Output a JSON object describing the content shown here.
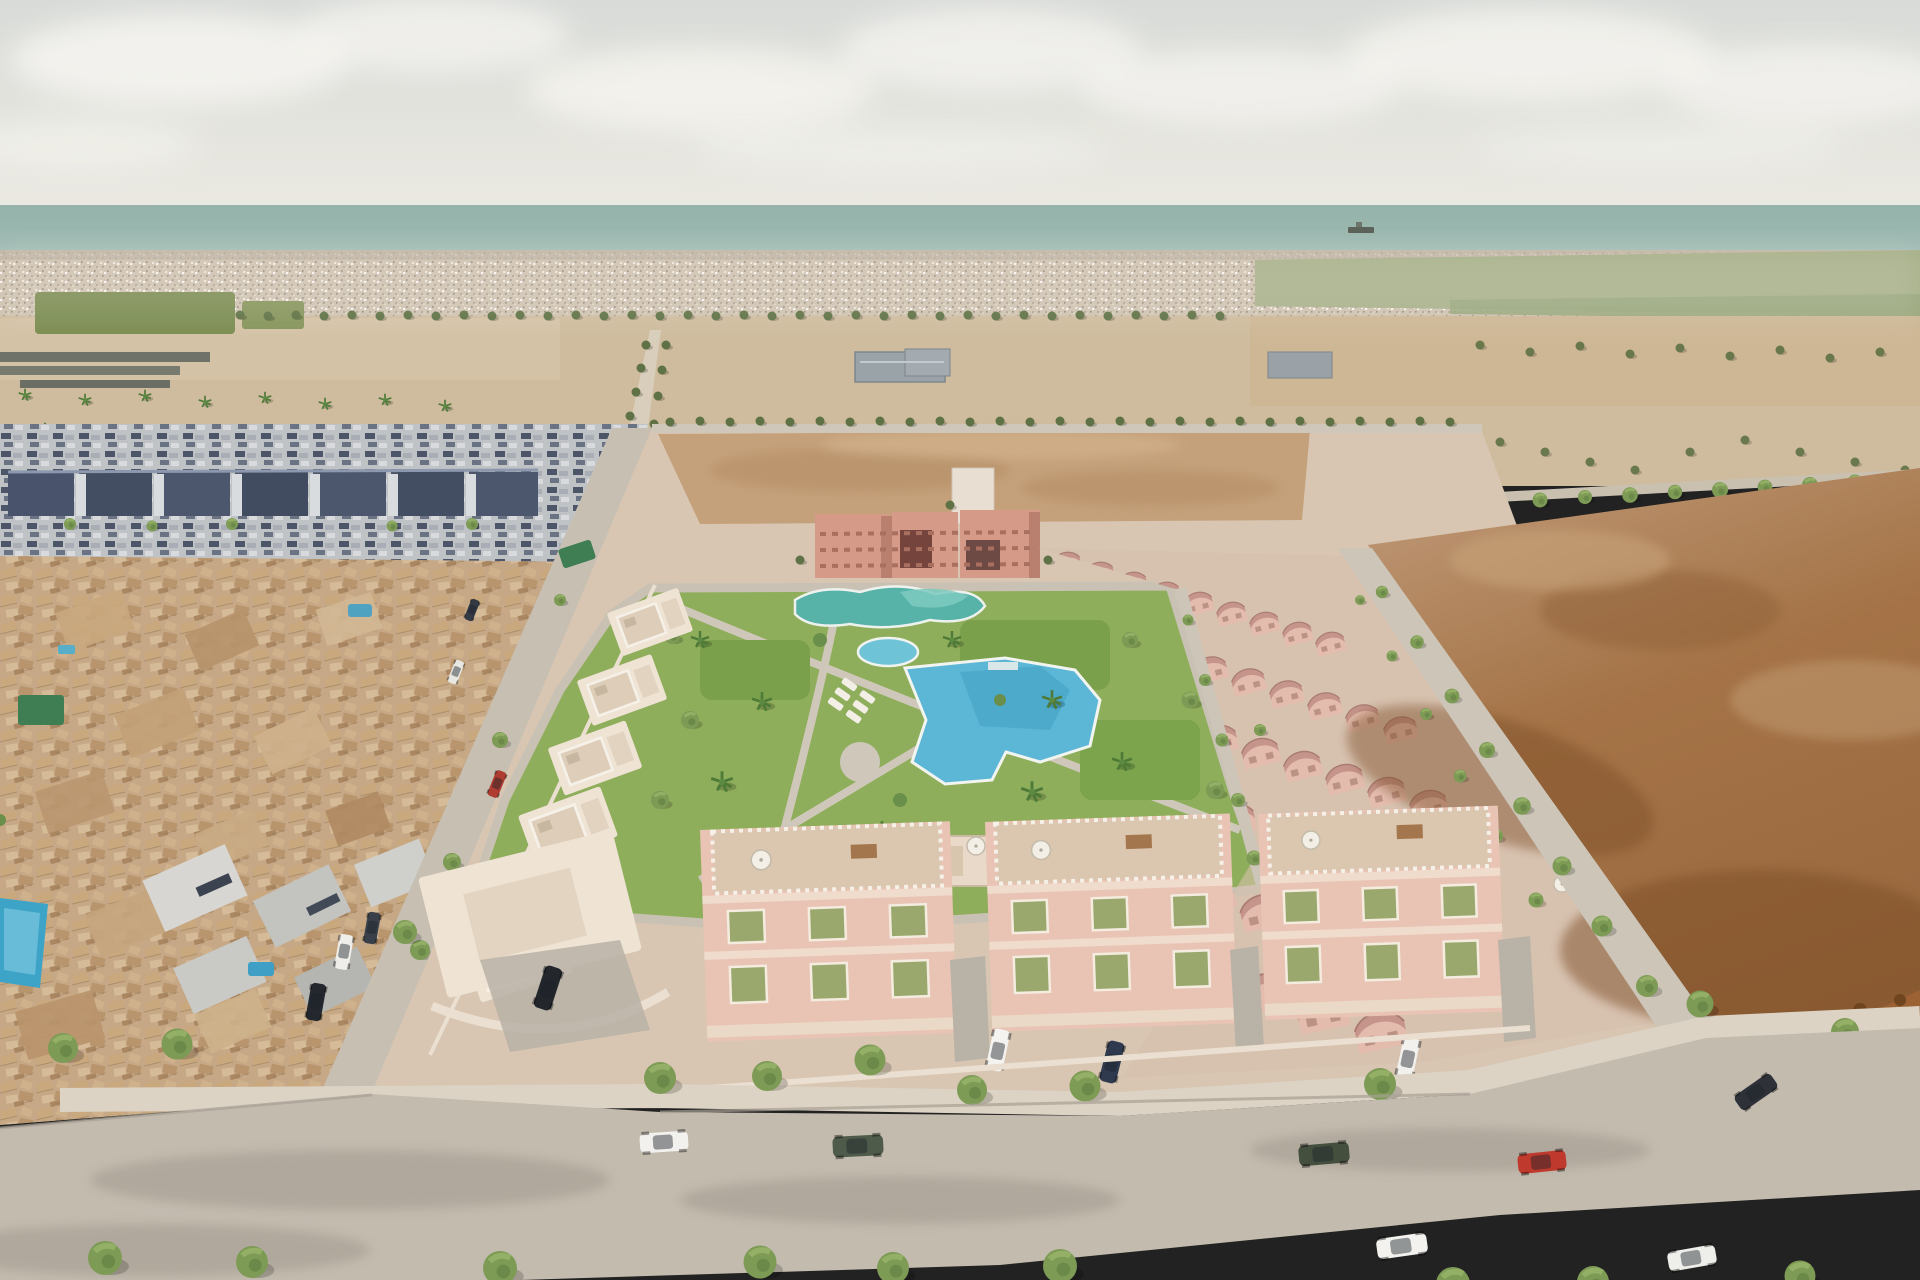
{
  "scene": {
    "type": "aerial-architectural-render",
    "description": "Aerial 3D render of a new-build coastal residential development: pink villas and apartment blocks around a central landscaped park with swimming pools, bordered by an older tan-roofed town on the left, empty sandy plots and a brown dirt field on the right, tree-lined streets with parked cars, distant low-rise town, green fields and the sea on the horizon under a pale overcast sky",
    "landmarks": [
      "sky",
      "clouds",
      "sea",
      "cargo-ship",
      "distant-town",
      "green-fields",
      "orchard-field",
      "sandy-plots",
      "warehouses",
      "gray-housing-estate",
      "old-town",
      "old-town-street",
      "development-pavement",
      "sand-mound",
      "apartment-row",
      "central-park",
      "lagoon-pool",
      "kidney-pool",
      "main-pool",
      "community-building",
      "cream-villa-row",
      "pink-villa-rows",
      "boundary-road",
      "dirt-field",
      "foreground-townhouses",
      "foreground-road",
      "street-trees",
      "private-pool"
    ]
  },
  "colors": {
    "sky_top": "#d9dcd9",
    "sky_horizon": "#eae8e1",
    "cloud": "#f4f3ef",
    "sea": "#96b4ab",
    "ship": "#5a6158",
    "coast_town": "#cfc2b0",
    "field_sand": "#cfbc9e",
    "orchard_green": "#7c8d52",
    "pale_field_green": "#a7b089",
    "sand_mound": "#c5a17b",
    "dirt_field": "#ab7a4d",
    "dirt_dark": "#7d4e28",
    "old_town": "#c6a886",
    "gray_estate_roof": "#49536b",
    "gray_estate_wall": "#c6cacf",
    "warehouse_gray": "#9aa3a8",
    "development_pavement": "#d8c6b3",
    "park_green": "#8fae5b",
    "pool_main": "#5cb6d6",
    "pool_lagoon": "#57b2a8",
    "pool_small": "#6fc3d6",
    "private_pool": "#3da4c8",
    "apartment_wall": "#d69a88",
    "apartment_dark": "#74443d",
    "villa_wall": "#e3bcae",
    "villa_roof": "#c5948a",
    "townhouse_wall": "#e9c4b4",
    "cream_villa": "#efe3d4",
    "shutter_green": "#9aa86d",
    "road": "#c3bbae",
    "street": "#c6bfb2",
    "sidewalk": "#dcd3c4",
    "tree": "#7d9b55",
    "tree_dark": "#5f7245",
    "palm": "#5d8a43",
    "balustrade": "#f6f1e8",
    "parasol": "#f3efe6"
  },
  "vehicles": [
    {
      "name": "white-hatchback-parked",
      "color": "#f2f1ee"
    },
    {
      "name": "dark-green-suv-driving",
      "color": "#4f5b4a"
    },
    {
      "name": "dark-green-suv-parked",
      "color": "#454f3e"
    },
    {
      "name": "red-car-parked",
      "color": "#bf3a2d"
    },
    {
      "name": "white-car-bottom",
      "color": "#f3f2ef"
    },
    {
      "name": "dark-car-right",
      "color": "#2e3238"
    },
    {
      "name": "white-car-bottom-right",
      "color": "#eeeeea"
    },
    {
      "name": "white-sedan-driveway",
      "color": "#f4f3f0"
    },
    {
      "name": "navy-car-driveway",
      "color": "#2f3a4e"
    },
    {
      "name": "navy-car-driveway-2",
      "color": "#333c4c"
    },
    {
      "name": "white-car-driveway-2",
      "color": "#f2f1ed"
    },
    {
      "name": "black-suv-courtyard",
      "color": "#23262b"
    },
    {
      "name": "white-car-left-street",
      "color": "#efeeea"
    },
    {
      "name": "dark-car-left-street",
      "color": "#3a4049"
    },
    {
      "name": "black-suv-left-street",
      "color": "#24272e"
    },
    {
      "name": "red-car-old-town",
      "color": "#ae3c31"
    },
    {
      "name": "white-van-old-town",
      "color": "#e8e7e2"
    },
    {
      "name": "dark-car-old-town",
      "color": "#343a44"
    }
  ],
  "counts": {
    "foreground_townhouse_blocks": 3,
    "pink_villa_rows": 6,
    "park_pools": 4
  }
}
